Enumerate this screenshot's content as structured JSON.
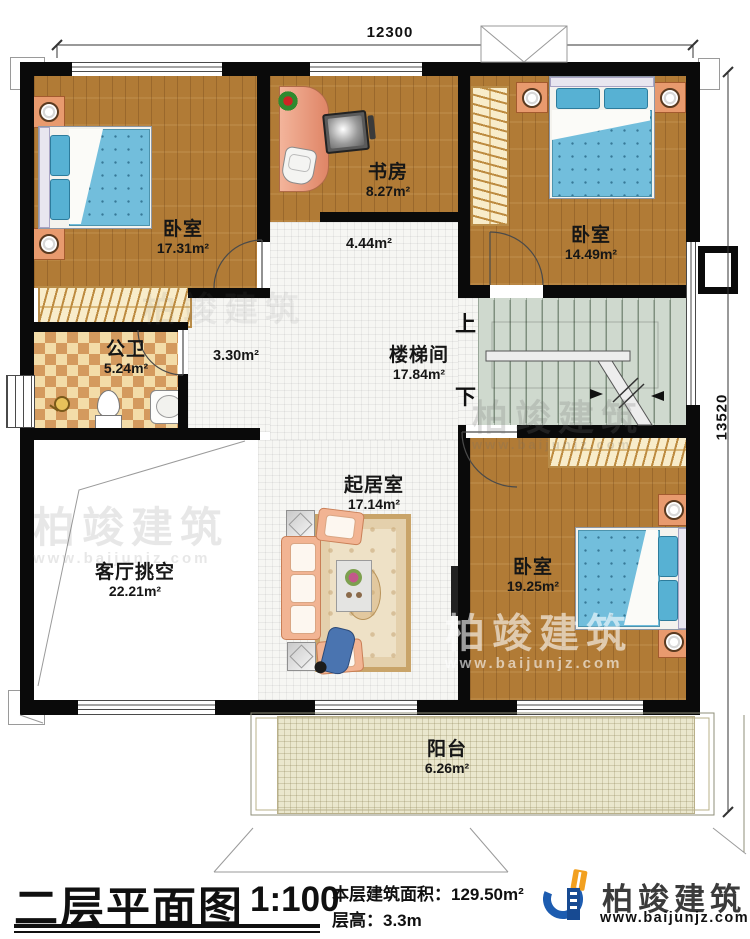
{
  "plan": {
    "dimensions": {
      "width": "12300",
      "height": "13520"
    },
    "rooms": [
      {
        "name": "卧室",
        "area": "17.31m²"
      },
      {
        "name": "书房",
        "area": "8.27m²"
      },
      {
        "name": "卧室",
        "area": "14.49m²"
      },
      {
        "name": "公卫",
        "area": "5.24m²"
      },
      {
        "name": "楼梯间",
        "area": "17.84m²"
      },
      {
        "name": "客厅挑空",
        "area": "22.21m²"
      },
      {
        "name": "起居室",
        "area": "17.14m²"
      },
      {
        "name": "卧室",
        "area": "19.25m²"
      },
      {
        "name": "阳台",
        "area": "6.26m²"
      }
    ],
    "corridor_areas": [
      "4.44m²",
      "3.30m²"
    ],
    "stair_labels": {
      "up": "上",
      "down": "下"
    }
  },
  "watermark": {
    "brand": "柏竣建筑",
    "website": "www.baijunjz.com"
  },
  "footer": {
    "title": "二层平面图",
    "scale": "1:100",
    "area_label": "本层建筑面积：",
    "area_value": "129.50m²",
    "height_label": "层高：",
    "height_value": "3.3m",
    "brand": "柏竣建筑",
    "website": "www.baijunjz.com"
  },
  "colors": {
    "wall": "#0a0a0a",
    "wood_floor": "#b17b36",
    "bed_blue": "#72bedc",
    "brand_blue": "#1d5cb0",
    "brand_orange": "#f2a01f"
  }
}
